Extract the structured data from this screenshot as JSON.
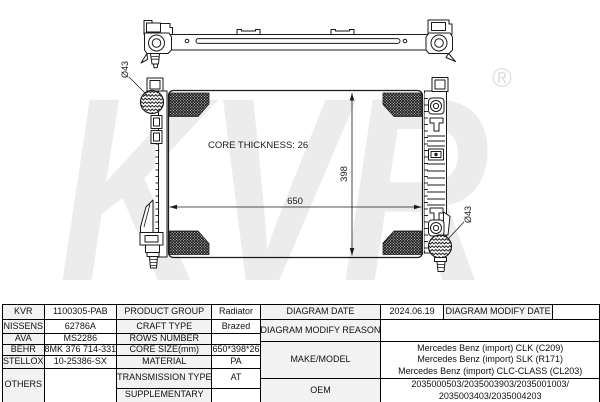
{
  "watermark": {
    "text": "KVR",
    "registered": "®",
    "color": "#ececec"
  },
  "colors": {
    "line": "#1a1a1a",
    "table_border": "#000000",
    "label_shade": "#f2f2f2",
    "background": "#ffffff"
  },
  "drawing": {
    "core_thickness_label": "CORE THICKNESS: 26",
    "width_dim": "650",
    "height_dim": "398",
    "left_port_dia": "Ø43",
    "right_port_dia": "Ø43"
  },
  "table": {
    "left": {
      "rows": [
        {
          "brand": "KVR",
          "code": "1100305-PAB",
          "prop": "PRODUCT GROUP",
          "value": "Radiator"
        },
        {
          "brand": "NISSENS",
          "code": "62786A",
          "prop": "CRAFT TYPE",
          "value": "Brazed"
        },
        {
          "brand": "AVA",
          "code": "MS2286",
          "prop": "ROWS NUMBER",
          "value": ""
        },
        {
          "brand": "BEHR",
          "code": "8MK 376 714-331",
          "prop": "CORE SIZE(mm)",
          "value": "650*398*26"
        },
        {
          "brand": "STELLOX",
          "code": "10-25386-SX",
          "prop": "MATERIAL",
          "value": "PA"
        },
        {
          "brand": "OTHERS",
          "code": "",
          "prop": "TRANSMISSION TYPE",
          "value": "AT"
        },
        {
          "prop": "SUPPLEMENTARY",
          "value": ""
        }
      ]
    },
    "right": {
      "diagram_date_label": "DIAGRAM DATE",
      "diagram_date": "2024.06.19",
      "modify_date_label": "DIAGRAM MODIFY DATE",
      "modify_date": "",
      "modify_reason_label": "DIAGRAM MODIFY REASON",
      "modify_reason": "",
      "make_model_label": "MAKE/MODEL",
      "make_model": [
        "Mercedes Benz (import) CLK (C209)",
        "Mercedes Benz (import) SLK (R171)",
        "Mercedes Benz (import) CLC-CLASS (CL203)"
      ],
      "oem_label": "OEM",
      "oem": [
        "2035000503/2035003903/2035001003/",
        "2035003403/2035004203"
      ]
    }
  }
}
